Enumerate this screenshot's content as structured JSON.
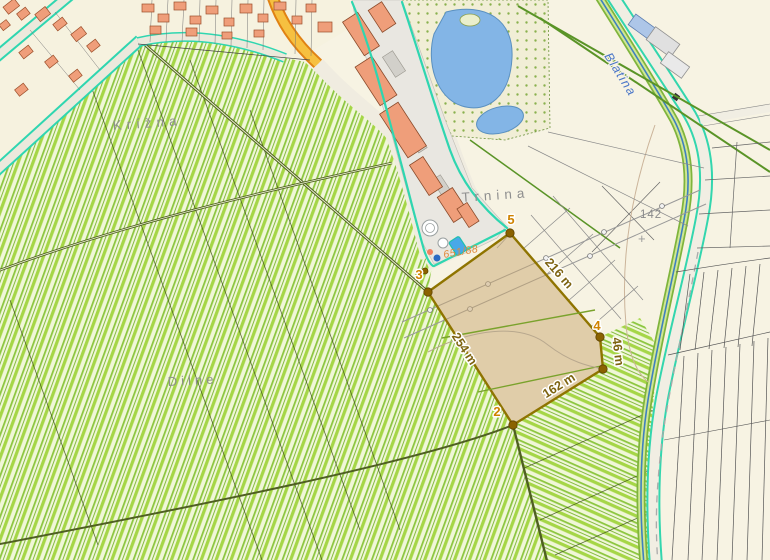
{
  "title": "Cadastral map with distance measurement",
  "labels": {
    "krizna": "Krížna",
    "trnina": "Trnina",
    "dilne": "Dilne",
    "blatina": "Blatina",
    "parcel_number": "651/88",
    "point_number": "142",
    "cross_symbol": "+"
  },
  "measurement": {
    "v2": "2",
    "v3": "3",
    "v4": "4",
    "v5": "5",
    "d216": "216 m",
    "d254": "254 m",
    "d162": "162 m",
    "d46": "46 m"
  },
  "colors": {
    "field_background": "#f0f7d8",
    "vineyard_stripe": "#a5d647",
    "measure_fill": "#c9a76f",
    "measure_outline": "#8f7400",
    "vertex_label": "#cf8300",
    "distance_label": "#7d6310",
    "road_edge_teal": "#2fd6b0",
    "water": "#83b5e6",
    "building": "#ef9e7a",
    "stream_label": "#4a76c8",
    "place_label": "#8f8f8f"
  }
}
